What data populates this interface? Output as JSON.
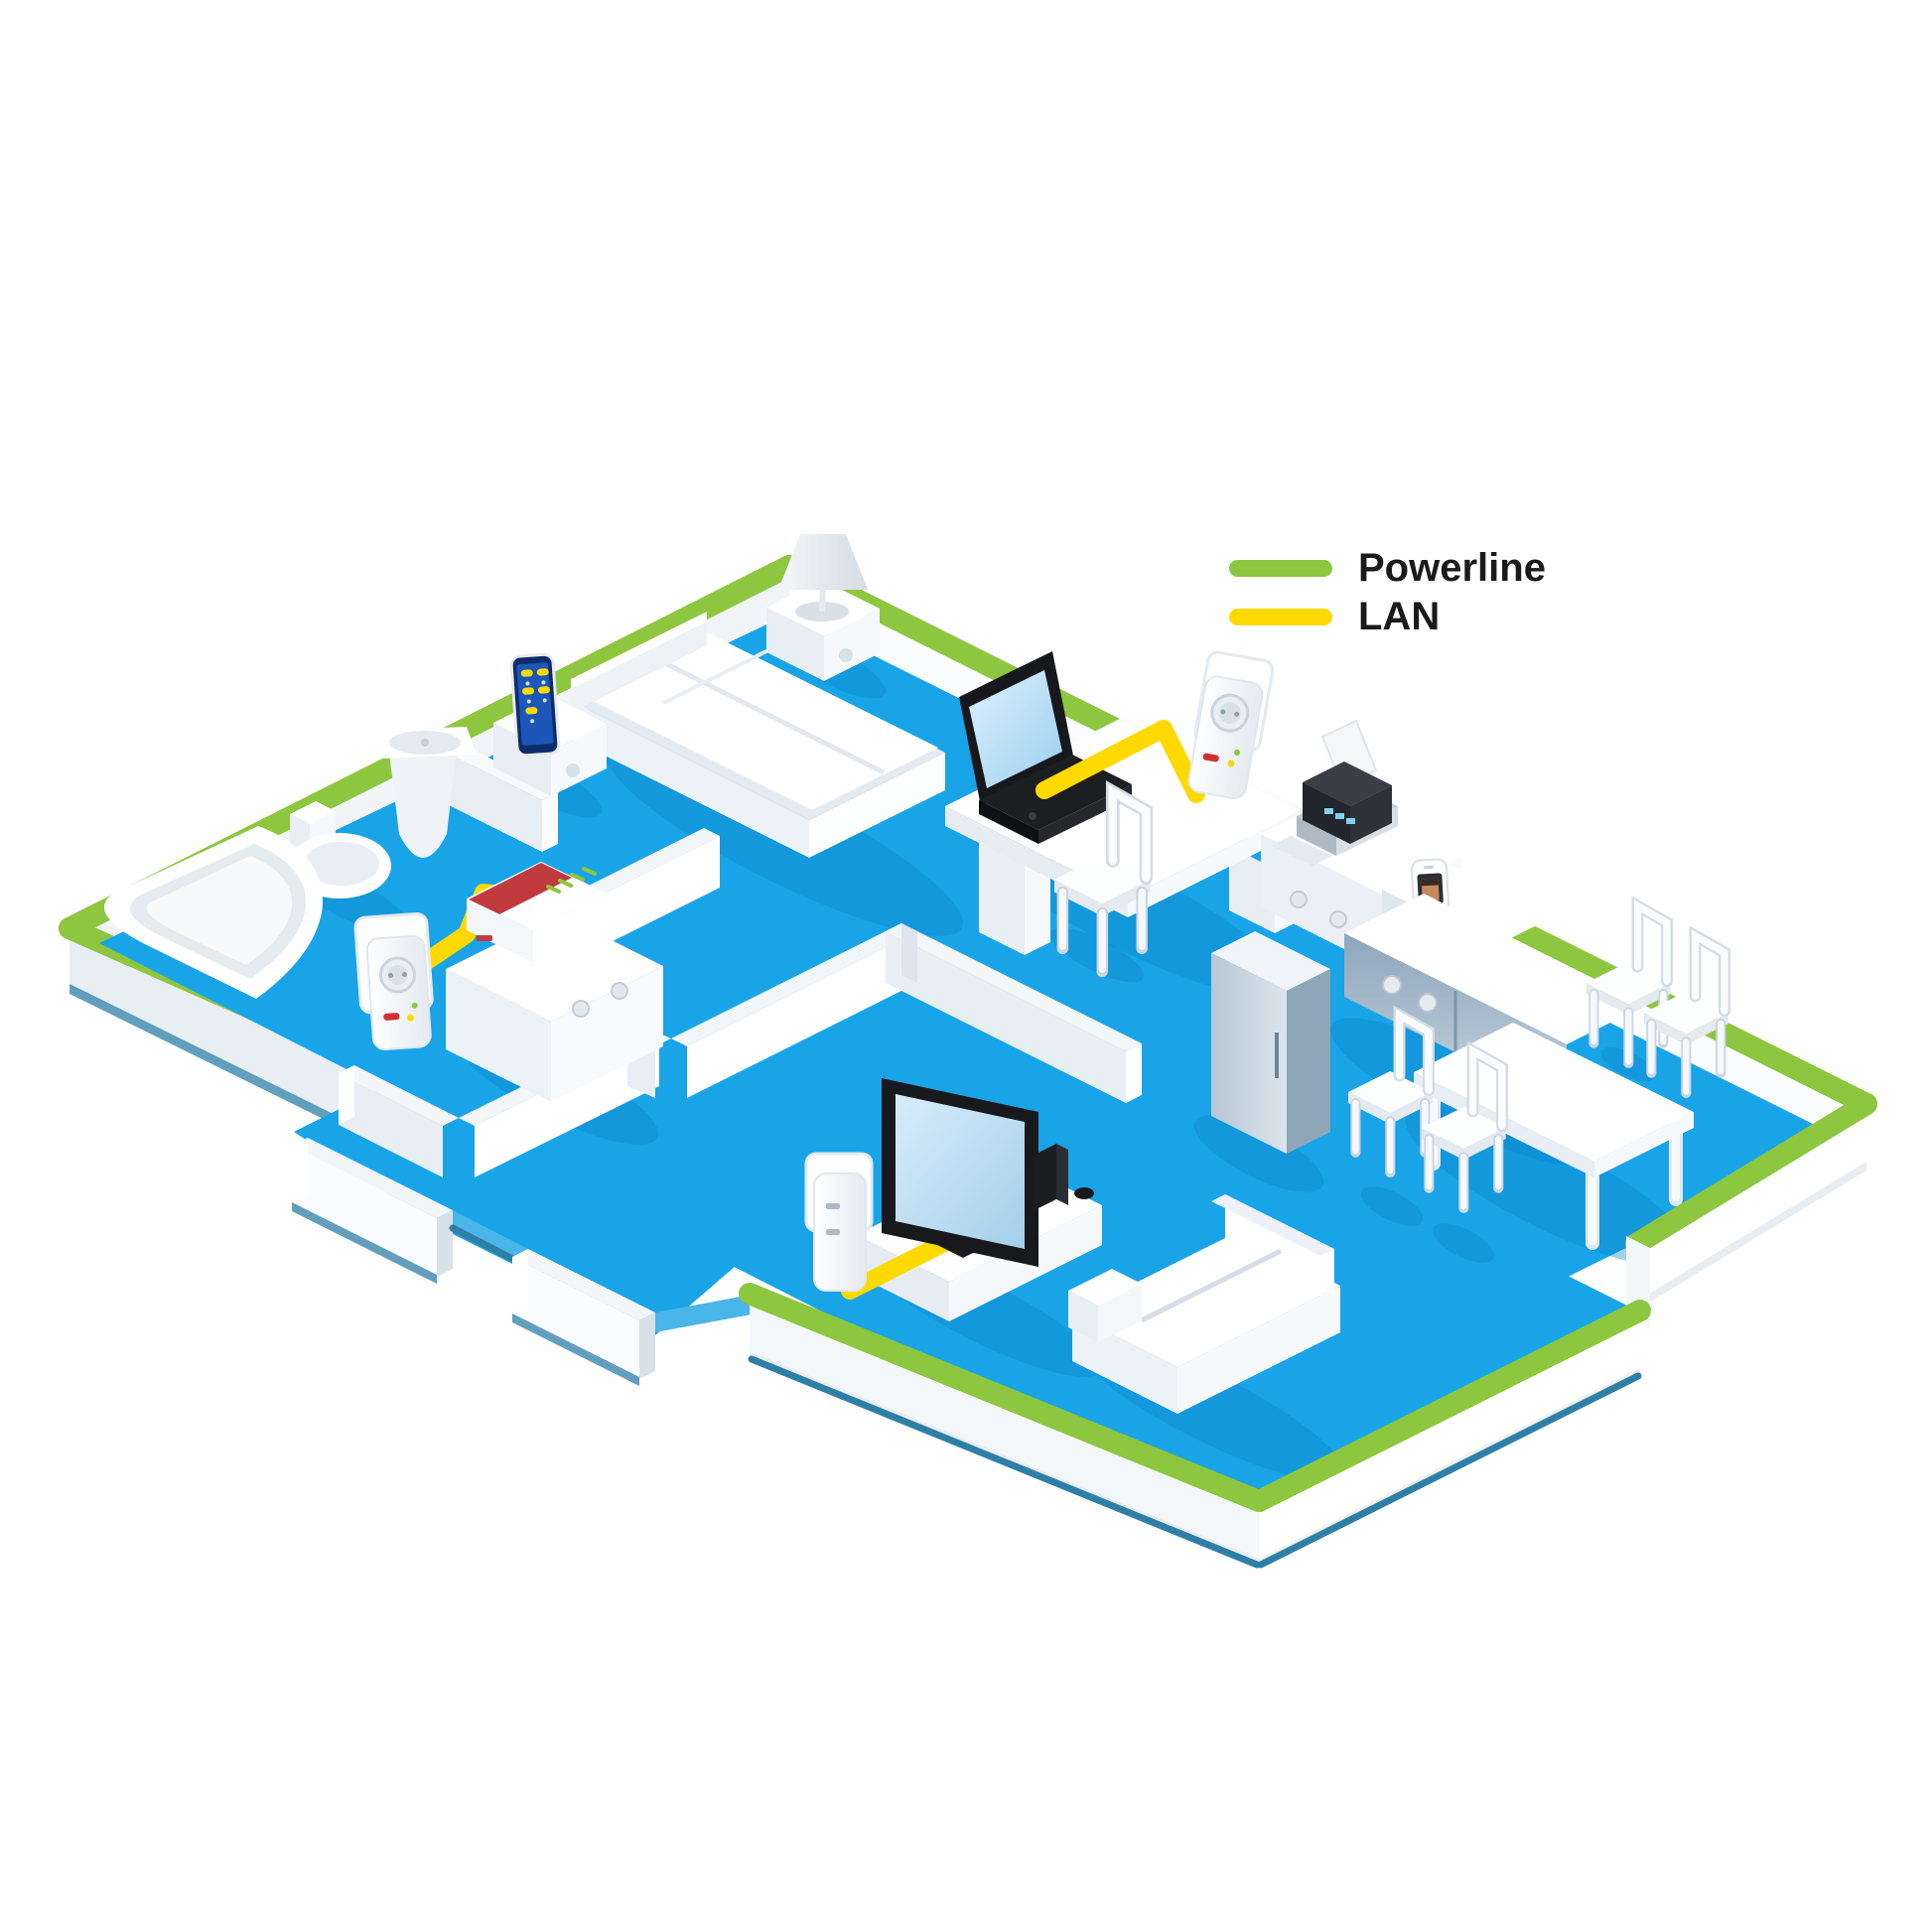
{
  "legend": {
    "items": [
      {
        "id": "powerline",
        "label": "Powerline"
      },
      {
        "id": "lan",
        "label": "LAN"
      }
    ]
  },
  "colors": {
    "powerline-green": "#8DC63F",
    "lan-yellow": "#FFD900",
    "floor-blue": "#18A4E7",
    "floor-shadow": "#0B86C8",
    "slab-edge": "#2E7FA6",
    "router-red": "#C13A3F",
    "screen-blue": "#BFE2F7",
    "text-black": "#1A1A1A"
  },
  "scene": {
    "rooms": [
      "bathroom",
      "bedroom",
      "hallway",
      "office",
      "kitchen",
      "dining-area",
      "living-room"
    ],
    "devices": [
      "fritzbox-router",
      "powerline-adapter-hall",
      "powerline-adapter-office-wall",
      "powerline-adapter-living-room",
      "laptop",
      "smart-tv",
      "game-console",
      "smartphone",
      "cordless-phone",
      "printer"
    ],
    "connections": [
      {
        "type": "powerline",
        "route": "house-perimeter-walls"
      },
      {
        "type": "lan",
        "route": "router-to-adapter"
      },
      {
        "type": "lan",
        "route": "laptop-to-adapter"
      },
      {
        "type": "lan",
        "route": "tv-to-adapter"
      }
    ]
  }
}
